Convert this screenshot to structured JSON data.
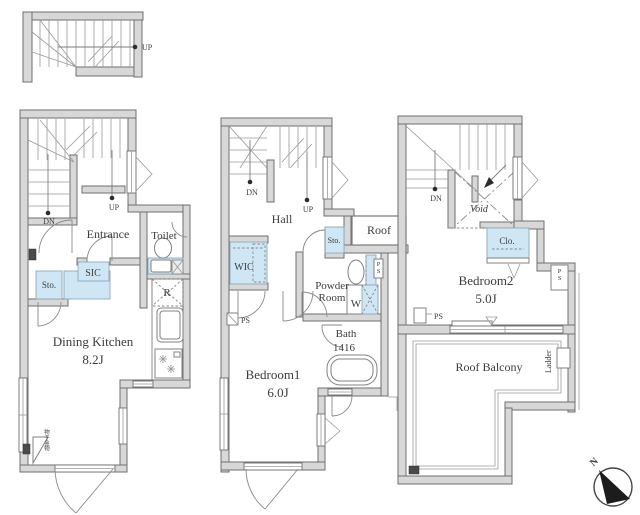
{
  "colors": {
    "wall_fill": "#d8d8d8",
    "wall_stroke": "#6f6f6f",
    "closet_blue": "#cfe6f4",
    "text": "#3c3c3c"
  },
  "entry_stair": {
    "up": "UP"
  },
  "floor1": {
    "dn": "DN",
    "up": "UP",
    "entrance": "Entrance",
    "toilet": "Toilet",
    "sic": "SIC",
    "storage": "Sto.",
    "refrigerator": "R",
    "name": "Dining Kitchen",
    "size": "8.2J",
    "corner_note": "物干金物"
  },
  "floor2": {
    "dn": "DN",
    "up": "UP",
    "hall": "Hall",
    "storage": "Sto.",
    "roof": "Roof",
    "wic": "WIC",
    "powder_word1": "Powder",
    "powder_word2": "Room",
    "ps": "PS",
    "ps_vertical": "PS",
    "washer": "W",
    "bath": "Bath",
    "bath_size": "1416",
    "name": "Bedroom1",
    "size": "6.0J"
  },
  "floor3": {
    "dn": "DN",
    "void": "Void",
    "closet": "Clo.",
    "name": "Bedroom2",
    "size": "5.0J",
    "ps": "PS",
    "ps_vertical": "PS",
    "balcony": "Roof Balcony",
    "ladder": "Ladder"
  },
  "compass": {
    "north": "N"
  }
}
